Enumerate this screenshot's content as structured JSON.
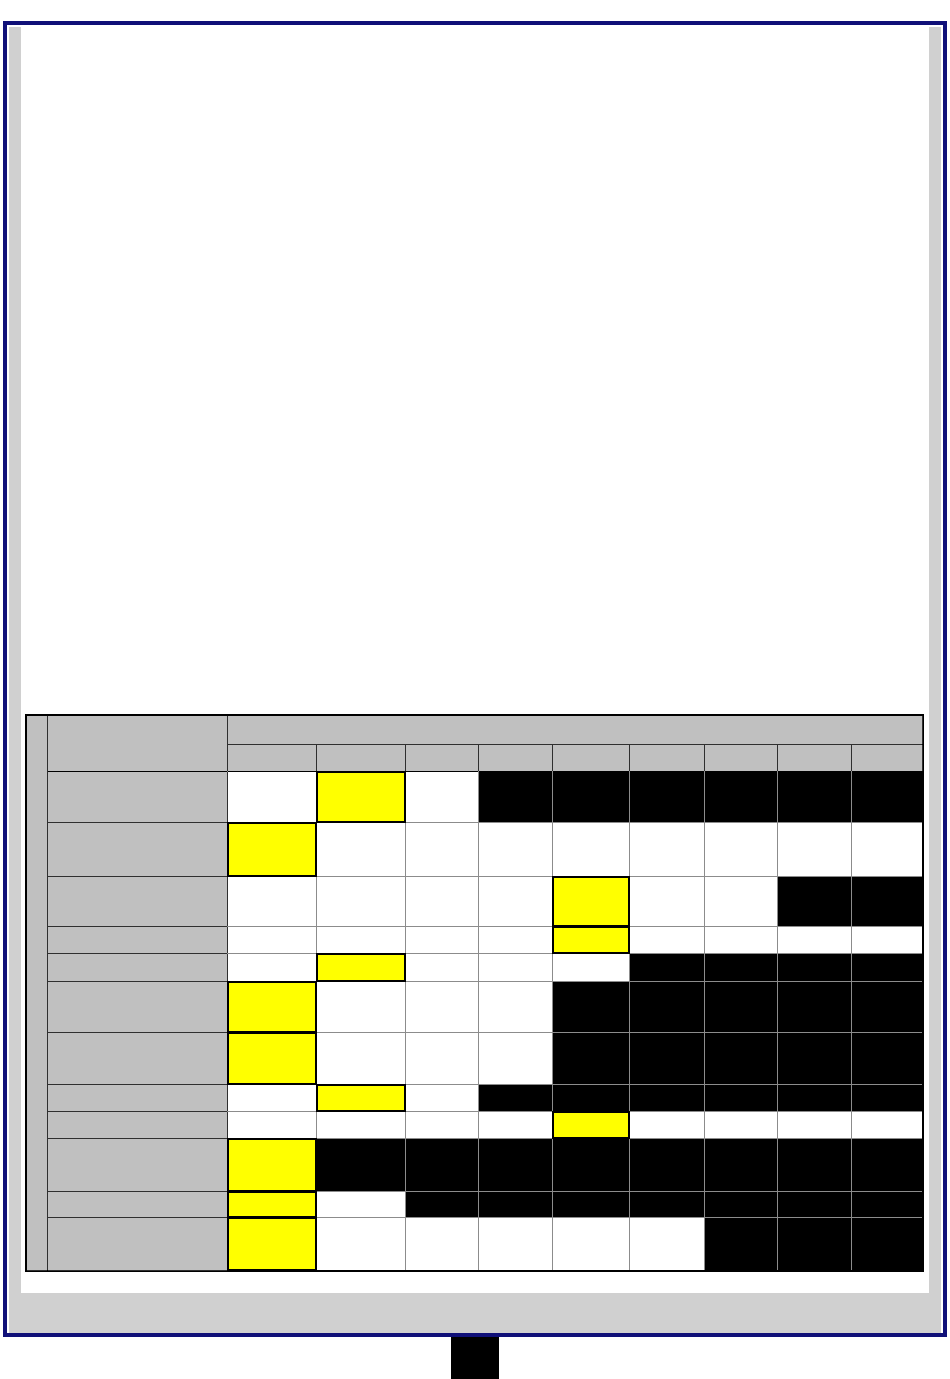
{
  "window": {
    "colors": {
      "border": "#101078",
      "margin": "#d0d0d0",
      "page": "#ffffff"
    }
  },
  "table": {
    "colors": {
      "header_fill": "#c0c0c0",
      "grid_line": "#8c8c8c",
      "dark_line": "#2f2f2f",
      "cell_white": "#ffffff",
      "cell_yellow": "#ffff00",
      "cell_black": "#000000",
      "border": "#000000"
    },
    "corner_label": "",
    "group_header_label": "",
    "column_headers": [
      "",
      "",
      "",
      "",
      "",
      "",
      "",
      "",
      ""
    ],
    "rows": [
      {
        "label": "",
        "cells": [
          "white",
          "yellow",
          "white",
          "black",
          "black",
          "black",
          "black",
          "black",
          "black"
        ]
      },
      {
        "label": "",
        "cells": [
          "yellow",
          "white",
          "white",
          "white",
          "white",
          "white",
          "white",
          "white",
          "white"
        ]
      },
      {
        "label": "",
        "cells": [
          "white",
          "white",
          "white",
          "white",
          "yellow",
          "white",
          "white",
          "black",
          "black"
        ]
      },
      {
        "label": "",
        "cells": [
          "white",
          "white",
          "white",
          "white",
          "yellow",
          "white",
          "white",
          "white",
          "white"
        ]
      },
      {
        "label": "",
        "cells": [
          "white",
          "yellow",
          "white",
          "white",
          "white",
          "black",
          "black",
          "black",
          "black"
        ]
      },
      {
        "label": "",
        "cells": [
          "yellow",
          "white",
          "white",
          "white",
          "black",
          "black",
          "black",
          "black",
          "black"
        ]
      },
      {
        "label": "",
        "cells": [
          "yellow",
          "white",
          "white",
          "white",
          "black",
          "black",
          "black",
          "black",
          "black"
        ]
      },
      {
        "label": "",
        "cells": [
          "white",
          "yellow",
          "white",
          "black",
          "black",
          "black",
          "black",
          "black",
          "black"
        ]
      },
      {
        "label": "",
        "cells": [
          "white",
          "white",
          "white",
          "white",
          "yellow",
          "white",
          "white",
          "white",
          "white"
        ]
      },
      {
        "label": "",
        "cells": [
          "yellow",
          "black",
          "black",
          "black",
          "black",
          "black",
          "black",
          "black",
          "black"
        ]
      },
      {
        "label": "",
        "cells": [
          "yellow",
          "white",
          "black",
          "black",
          "black",
          "black",
          "black",
          "black",
          "black"
        ]
      },
      {
        "label": "",
        "cells": [
          "yellow",
          "white",
          "white",
          "white",
          "white",
          "white",
          "black",
          "black",
          "black"
        ]
      }
    ]
  },
  "marker": {
    "color": "#000000"
  }
}
